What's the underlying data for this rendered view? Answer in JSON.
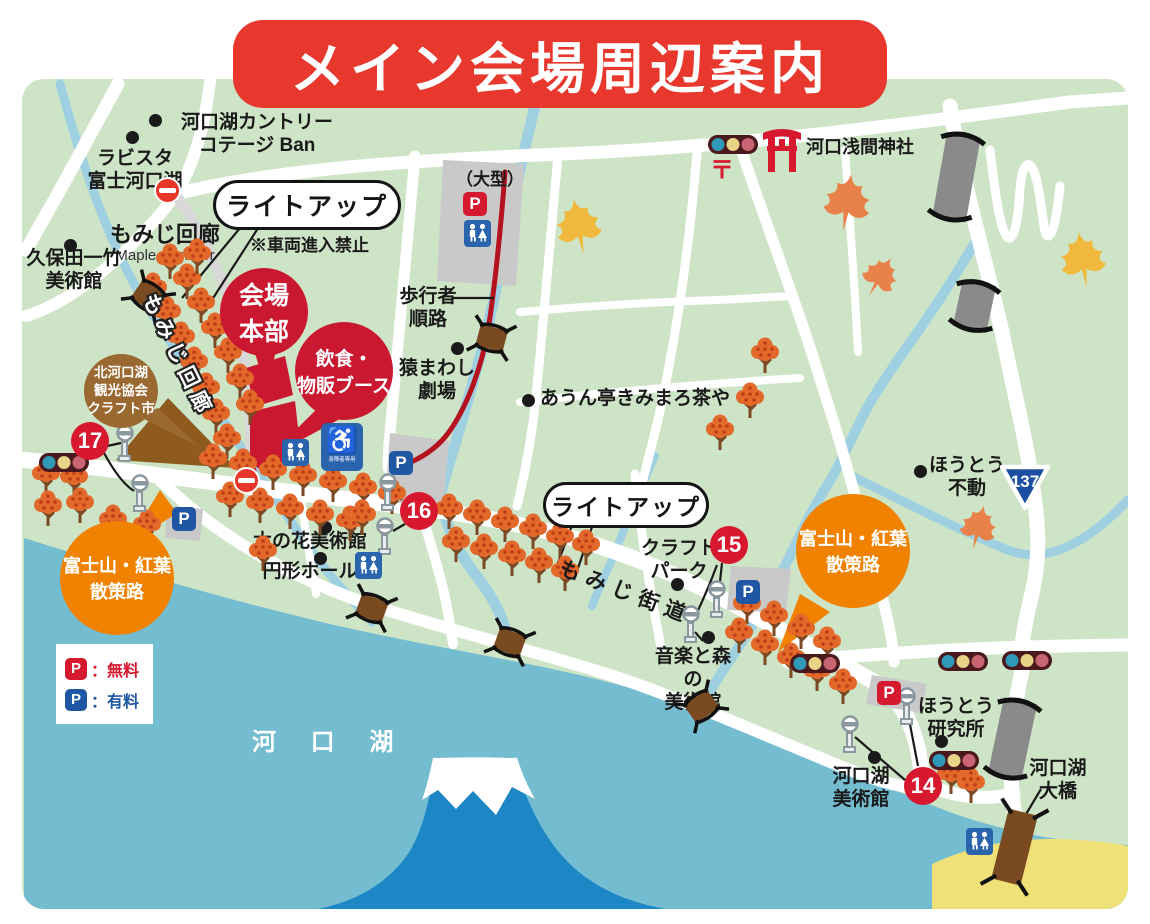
{
  "title": "メイン会場周辺案内",
  "legend": {
    "p": "P",
    "free_label": "：無料",
    "paid_label": "：有料"
  },
  "lake": {
    "name": "河 口 湖"
  },
  "route_badge": "137",
  "markers": {
    "m14": "14",
    "m15": "15",
    "m16": "16",
    "m17": "17"
  },
  "callouts": {
    "lightup1": "ライトアップ",
    "lightup2": "ライトアップ",
    "venue_hq": "会場\n本部",
    "food_booth": "飲食・\n物販ブース",
    "craft_market": "北河口湖\n観光協会\nクラフト市",
    "strolling_path_left": "富士山・紅葉\n散策路",
    "strolling_path_right": "富士山・紅葉\n散策路"
  },
  "notes": {
    "no_vehicle": "※車両進入禁止",
    "pedestrian_route": "歩行者\n順路",
    "large_parking": "（大型）",
    "accessible_parking": "身障者専用",
    "post_mark": "〒"
  },
  "paths": {
    "maple_corridor_road": "もみじ回廊",
    "momiji_kaido": "もみじ街道"
  },
  "places": {
    "country_cottage": "河口湖カントリー\nコテージ Ban",
    "lavista": "ラビスタ\n富士河口湖",
    "maple_corridor": "もみじ回廊",
    "maple_corridor_en": "Maple Corridor",
    "kubota": "久保田一竹\n美術館",
    "monkey_theater": "猿まわし\n劇場",
    "aun_tei": "あうん亭きみまろ茶や",
    "sengen_shrine": "河口浅間神社",
    "hoto_fudo": "ほうとう\n不動",
    "konohana": "木の花美術館",
    "enkei_hall": "円形ホール",
    "craft_park": "クラフト\nパーク",
    "music_forest": "音楽と森の\n美術館",
    "hoto_lab": "ほうとう\n研究所",
    "kawaguchiko_museum": "河口湖\n美術館",
    "ohashi": "河口湖\n大橋"
  },
  "colors": {
    "title_red": "#e8382d",
    "marker_red": "#d8182f",
    "venue_red": "#c9182f",
    "accent_orange": "#f08200",
    "map_green": "#cee4c6",
    "lake_blue": "#74bdd1",
    "fuji_blue": "#1d87c6",
    "stream_blue": "#9fd0e2",
    "free_parking_red": "#d5192e",
    "paid_parking_blue": "#1f57a5",
    "craft_brown": "#9a6932"
  }
}
